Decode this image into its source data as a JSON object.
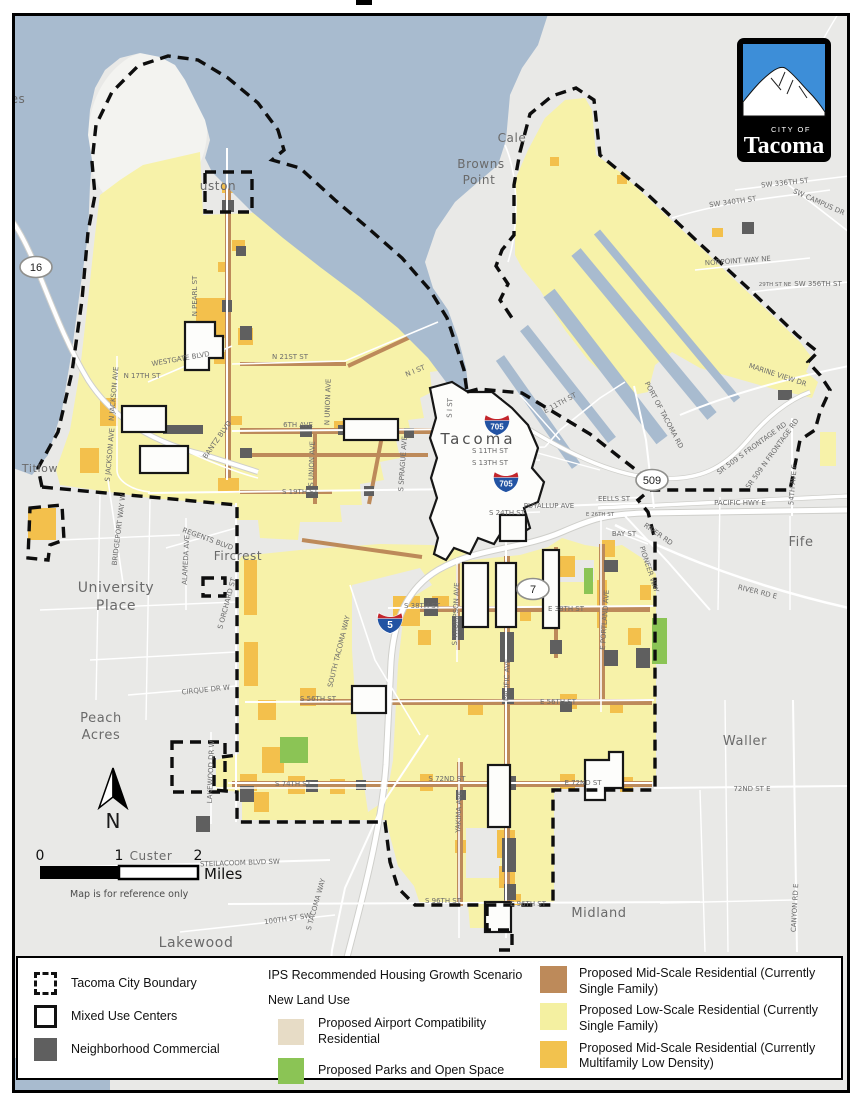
{
  "map": {
    "colors": {
      "water": "#a8bbcf",
      "land": "#e9e9e7",
      "peninsula": "#f3f3f0",
      "lowscale": "#f7f2a9",
      "mid_mf": "#f3c04c",
      "mid_sf": "#bd8a5a",
      "commercial": "#5f5f5f",
      "airport": "#e7dcc6",
      "parks": "#8bc455",
      "muc": "#fdfdfb",
      "downtown": "#ededeb",
      "shield_blue": "#2253a3",
      "shield_red": "#c3262c"
    },
    "place_labels": [
      [
        "Adelaide",
        816,
        16,
        12
      ],
      [
        "es",
        18,
        103,
        12
      ],
      [
        "uston",
        218,
        190,
        12
      ],
      [
        "Cale",
        512,
        142,
        12
      ],
      [
        "Browns",
        481,
        168,
        12
      ],
      [
        "Point",
        479,
        184,
        12
      ],
      [
        "University",
        116,
        592,
        14
      ],
      [
        "Place",
        116,
        610,
        14
      ],
      [
        "Fircrest",
        238,
        560,
        12
      ],
      [
        "Peach",
        101,
        722,
        13
      ],
      [
        "Acres",
        101,
        739,
        13
      ],
      [
        "Custer",
        151,
        860,
        12
      ],
      [
        "Lakewood",
        196,
        947,
        14
      ],
      [
        "Midland",
        599,
        917,
        13
      ],
      [
        "Waller",
        745,
        745,
        13
      ],
      [
        "Fife",
        801,
        546,
        13
      ],
      [
        "Titlow",
        40,
        472,
        11
      ]
    ],
    "city_label": "Tacoma",
    "street_labels": [
      [
        "N PEARL ST",
        197,
        296,
        -90
      ],
      [
        "WESTGATE BLVD",
        181,
        361,
        -10
      ],
      [
        "N 17TH ST",
        142,
        378,
        0
      ],
      [
        "N JACKSON AVE",
        116,
        394,
        -85
      ],
      [
        "S JACKSON AVE",
        112,
        455,
        -85
      ],
      [
        "BANTZ BLVD",
        219,
        441,
        -55
      ],
      [
        "BRIDGEPORT WAY W",
        121,
        530,
        -83
      ],
      [
        "REGENTS BLVD",
        207,
        541,
        20
      ],
      [
        "ALAMEDA AVE",
        188,
        560,
        -87
      ],
      [
        "S ORCHARD ST",
        229,
        604,
        -75
      ],
      [
        "CIRQUE DR W",
        206,
        692,
        -6
      ],
      [
        "N 21ST ST",
        290,
        359,
        0
      ],
      [
        "N I ST",
        416,
        373,
        -22
      ],
      [
        "N UNION AVE",
        330,
        402,
        -88
      ],
      [
        "6TH AVE",
        298,
        427,
        0
      ],
      [
        "S UNION AVE",
        314,
        464,
        -88
      ],
      [
        "S SPRAGUE AVE",
        405,
        464,
        -86
      ],
      [
        "S 19TH ST",
        300,
        494,
        0
      ],
      [
        "S I ST",
        452,
        408,
        -88
      ],
      [
        "S 11TH ST",
        490,
        453,
        0
      ],
      [
        "S 13TH ST",
        490,
        465,
        0
      ],
      [
        "E 11TH ST",
        561,
        405,
        -28
      ],
      [
        "PUYALLUP AVE",
        549,
        508,
        0
      ],
      [
        "S 24TH ST",
        507,
        515,
        0
      ],
      [
        "EELLS ST",
        614,
        501,
        0
      ],
      [
        "E 26TH ST",
        600,
        516,
        0,
        5.5
      ],
      [
        "BAY ST",
        624,
        536,
        0
      ],
      [
        "RIVER RD",
        657,
        536,
        35
      ],
      [
        "PIONEER WAY",
        647,
        570,
        72
      ],
      [
        "RIVER RD E",
        757,
        594,
        14
      ],
      [
        "PACIFIC HWY E",
        740,
        505,
        0
      ],
      [
        "54TH AVE E",
        795,
        485,
        -85
      ],
      [
        "SR 509 S FRONTAGE RD",
        753,
        450,
        -36
      ],
      [
        "SR 509 N FRONTAGE RD",
        774,
        455,
        -54
      ],
      [
        "PORT OF TACOMA RD",
        662,
        416,
        62
      ],
      [
        "S 38TH ST",
        422,
        608,
        0
      ],
      [
        "E 38TH ST",
        566,
        611,
        0
      ],
      [
        "S THOMPSON AVE",
        458,
        614,
        -88
      ],
      [
        "PACIFIC AVE",
        509,
        680,
        -88
      ],
      [
        "E PORTLAND AVE",
        607,
        620,
        -86
      ],
      [
        "SOUTH TACOMA WAY",
        341,
        652,
        -76
      ],
      [
        "S 56TH ST",
        318,
        701,
        0
      ],
      [
        "E 56TH ST",
        558,
        704,
        0
      ],
      [
        "S 72ND ST",
        447,
        781,
        0
      ],
      [
        "E 72ND ST",
        583,
        785,
        0
      ],
      [
        "S 74TH ST",
        293,
        786,
        0
      ],
      [
        "LAKEWOOD DR W",
        213,
        772,
        -88
      ],
      [
        "YAKIMA AVE",
        461,
        812,
        -88
      ],
      [
        "S 96TH ST",
        443,
        903,
        0
      ],
      [
        "E 96TH ST",
        528,
        906,
        0
      ],
      [
        "S TACOMA WAY",
        318,
        905,
        -74
      ],
      [
        "STEILACOOM BLVD SW",
        240,
        865,
        -2
      ],
      [
        "100TH ST SW",
        288,
        921,
        -8
      ],
      [
        "72ND ST E",
        752,
        791,
        0
      ],
      [
        "CANYON RD E",
        797,
        908,
        -87
      ],
      [
        "SW 336TH ST",
        785,
        185,
        -6
      ],
      [
        "SW 340TH ST",
        733,
        204,
        -8
      ],
      [
        "SW CAMPUS DR",
        818,
        204,
        24
      ],
      [
        "NORPOINT WAY NE",
        738,
        263,
        -4
      ],
      [
        "29TH ST NE",
        775,
        286,
        0,
        5.5
      ],
      [
        "SW 356TH ST",
        818,
        286,
        0
      ],
      [
        "MARINE VIEW DR",
        777,
        377,
        18
      ]
    ],
    "shields": {
      "interstate": [
        {
          "n": "705",
          "x": 497,
          "y": 424
        },
        {
          "n": "705",
          "x": 506,
          "y": 481
        },
        {
          "n": "5",
          "x": 390,
          "y": 622
        }
      ],
      "oval": [
        {
          "n": "16",
          "x": 36,
          "y": 267
        },
        {
          "n": "509",
          "x": 652,
          "y": 480
        },
        {
          "n": "7",
          "x": 533,
          "y": 589
        }
      ]
    },
    "north_arrow": {
      "label": "N"
    },
    "scale_bar": {
      "ticks": [
        "0",
        "1",
        "2"
      ],
      "unit": "Miles",
      "note": "Map is for reference only"
    },
    "logo": {
      "city_of": "CITY OF",
      "name": "Tacoma"
    }
  },
  "legend": {
    "left": [
      {
        "label": "Tacoma City Boundary",
        "swatch": "dashed"
      },
      {
        "label": "Mixed Use Centers",
        "swatch": "outline"
      },
      {
        "label": "Neighborhood Commercial",
        "swatch": "fill",
        "color": "#5f5f5f"
      }
    ],
    "title": "IPS Recommended Housing Growth Scenario",
    "subtitle": "New Land Use",
    "middle": [
      {
        "label": "Proposed Airport Compatibility Residential",
        "color": "#e7dcc6"
      },
      {
        "label": "Proposed Parks and Open Space",
        "color": "#8bc455"
      }
    ],
    "right": [
      {
        "label": "Proposed Mid-Scale Residential (Currently Single Family)",
        "color": "#bd8a5a"
      },
      {
        "label": "Proposed Low-Scale Residential (Currently Single Family)",
        "color": "#f4f0a1"
      },
      {
        "label": "Proposed Mid-Scale Residential (Currently Multifamily Low Density)",
        "color": "#f2c24e"
      }
    ]
  }
}
